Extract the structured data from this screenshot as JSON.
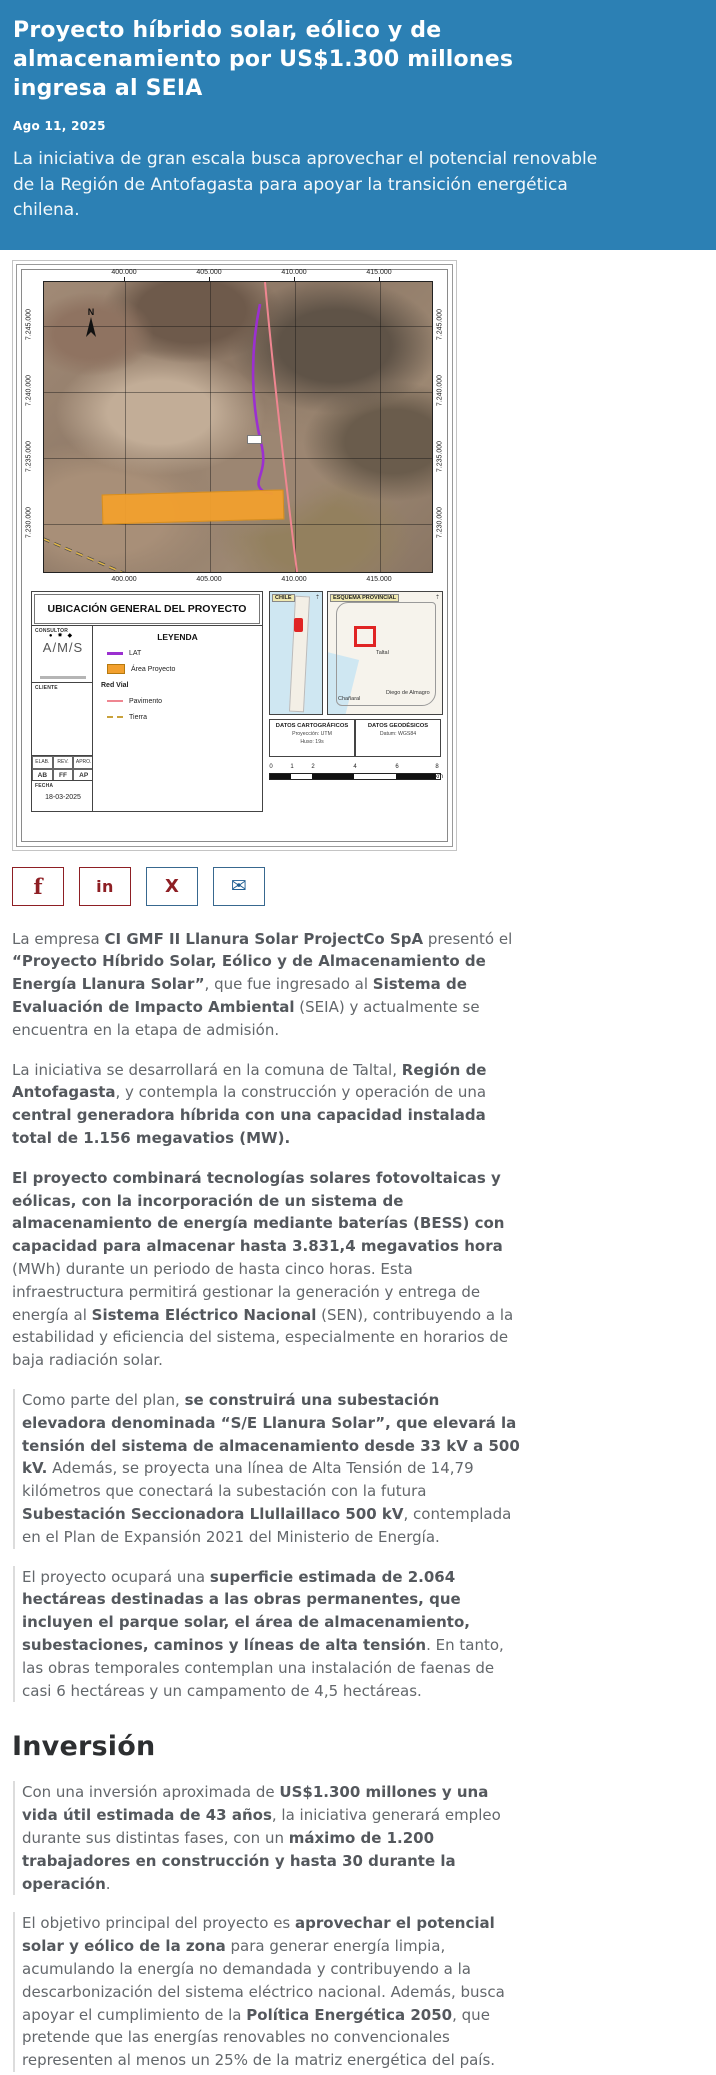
{
  "colors": {
    "header_bg": "#2c80b4",
    "share_maroon": "#8e1f24",
    "share_blue": "#205e92",
    "area_orange": "#f2a02e",
    "lat_purple": "#9b30d0",
    "pavimento_pink": "#ef8691"
  },
  "header": {
    "title": "Proyecto híbrido solar, eólico y de almacenamiento por US$1.300 millones ingresa al SEIA",
    "date": "Ago 11, 2025",
    "lead": "La iniciativa de gran escala busca aprovechar el potencial renovable de la Región de Antofagasta para apoyar la transición energética chilena."
  },
  "share": {
    "facebook_glyph": "f",
    "linkedin_glyph": "in",
    "x_glyph": "X",
    "mail_glyph": "✉"
  },
  "map": {
    "title": "UBICACIÓN GENERAL DEL PROYECTO",
    "north": "N",
    "x_labels": [
      "400.000",
      "405.000",
      "410.000",
      "415.000"
    ],
    "y_labels": [
      "7.245.000",
      "7.240.000",
      "7.235.000",
      "7.230.000"
    ],
    "consultor_label": "CONSULTOR",
    "consultor_logo": "A/M/S",
    "consultor_dots": "●✸◆",
    "cliente_label": "CLIENTE",
    "legend": {
      "title": "LEYENDA",
      "lat": "LAT",
      "area": "Área Proyecto",
      "red_vial": "Red Vial",
      "pavimento": "Pavimento",
      "tierra": "Tierra"
    },
    "approvals": {
      "h1": "ELAB.",
      "h2": "REV.",
      "h3": "APRO.",
      "v1": "AB",
      "v2": "FF",
      "v3": "AP"
    },
    "fecha_label": "FECHA",
    "fecha": "18-03-2025",
    "inset_chile": "CHILE",
    "inset_esquema": "ESQUEMA PROVINCIAL",
    "inset_taltal": "Taltal",
    "inset_chanaral": "Chañaral",
    "inset_diego": "Diego de Almagro",
    "datos_cart": {
      "title": "DATOS CARTOGRÁFICOS",
      "line1": "Proyección: UTM",
      "line2": "Huso: 19s"
    },
    "datos_geo": {
      "title": "DATOS GEODÉSICOS",
      "line1": "Datum: WGS84"
    },
    "scale": {
      "t0": "0",
      "t1": "1",
      "t2": "2",
      "t3": "4",
      "t4": "6",
      "t5": "8",
      "unit": "km"
    }
  },
  "article": {
    "blocks": [
      {
        "type": "p",
        "quote": false,
        "seg": [
          {
            "t": "La empresa ",
            "b": false
          },
          {
            "t": "CI GMF II Llanura Solar ProjectCo SpA",
            "b": true
          },
          {
            "t": " presentó el ",
            "b": false
          },
          {
            "t": "“Proyecto Híbrido Solar, Eólico y de Almacenamiento de Energía Llanura Solar”",
            "b": true
          },
          {
            "t": ", que fue ingresado al ",
            "b": false
          },
          {
            "t": "Sistema de Evaluación de Impacto Ambiental",
            "b": true
          },
          {
            "t": " (SEIA) y actualmente se encuentra en la etapa de admisión.",
            "b": false
          }
        ]
      },
      {
        "type": "p",
        "quote": false,
        "seg": [
          {
            "t": "La iniciativa se desarrollará en la comuna de Taltal, ",
            "b": false
          },
          {
            "t": "Región de Antofagasta",
            "b": true
          },
          {
            "t": ", y contempla la construcción y operación de una ",
            "b": false
          },
          {
            "t": "central generadora híbrida con una capacidad instalada total de 1.156 megavatios (MW).",
            "b": true
          }
        ]
      },
      {
        "type": "p",
        "quote": false,
        "seg": [
          {
            "t": "El proyecto combinará tecnologías solares fotovoltaicas y eólicas, con la incorporación de un sistema de almacenamiento de energía mediante baterías (BESS) con capacidad para almacenar hasta 3.831,4 megavatios hora",
            "b": true
          },
          {
            "t": " (MWh) durante un periodo de hasta cinco horas. Esta infraestructura permitirá gestionar la generación y entrega de energía al ",
            "b": false
          },
          {
            "t": "Sistema Eléctrico Nacional",
            "b": true
          },
          {
            "t": " (SEN), contribuyendo a la estabilidad y eficiencia del sistema, especialmente en horarios de baja radiación solar.",
            "b": false
          }
        ]
      },
      {
        "type": "p",
        "quote": true,
        "seg": [
          {
            "t": "Como parte del plan, ",
            "b": false
          },
          {
            "t": "se construirá una subestación elevadora denominada “S/E Llanura Solar”, que elevará la tensión del sistema de almacenamiento desde 33 kV a 500 kV.",
            "b": true
          },
          {
            "t": " Además, se proyecta una línea de Alta Tensión de 14,79 kilómetros que conectará la subestación con la futura ",
            "b": false
          },
          {
            "t": "Subestación Seccionadora Llullaillaco 500 kV",
            "b": true
          },
          {
            "t": ", contemplada en el Plan de Expansión 2021 del Ministerio de Energía.",
            "b": false
          }
        ]
      },
      {
        "type": "p",
        "quote": true,
        "seg": [
          {
            "t": "El proyecto ocupará una ",
            "b": false
          },
          {
            "t": "superficie estimada de 2.064 hectáreas destinadas a las obras permanentes, que incluyen el parque solar, el área de almacenamiento, subestaciones, caminos y líneas de alta tensión",
            "b": true
          },
          {
            "t": ". En tanto, las obras temporales contemplan una instalación de faenas de casi 6 hectáreas y un campamento de 4,5 hectáreas.",
            "b": false
          }
        ]
      },
      {
        "type": "h2",
        "text": "Inversión"
      },
      {
        "type": "p",
        "quote": true,
        "seg": [
          {
            "t": "Con una inversión aproximada de ",
            "b": false
          },
          {
            "t": "US$1.300 millones y una vida útil estimada de 43 años",
            "b": true
          },
          {
            "t": ", la iniciativa generará empleo durante sus distintas fases, con un ",
            "b": false
          },
          {
            "t": "máximo de 1.200 trabajadores en construcción y hasta 30 durante la operación",
            "b": true
          },
          {
            "t": ".",
            "b": false
          }
        ]
      },
      {
        "type": "p",
        "quote": true,
        "seg": [
          {
            "t": "El objetivo principal del proyecto es ",
            "b": false
          },
          {
            "t": "aprovechar el potencial solar y eólico de la zona",
            "b": true
          },
          {
            "t": " para generar energía limpia, acumulando la energía no demandada y contribuyendo a la descarbonización del sistema eléctrico nacional. Además, busca apoyar el cumplimiento de la ",
            "b": false
          },
          {
            "t": "Política Energética 2050",
            "b": true
          },
          {
            "t": ", que pretende que las energías renovables no convencionales representen al menos un 25% de la matriz energética del país.",
            "b": false
          }
        ]
      }
    ]
  }
}
